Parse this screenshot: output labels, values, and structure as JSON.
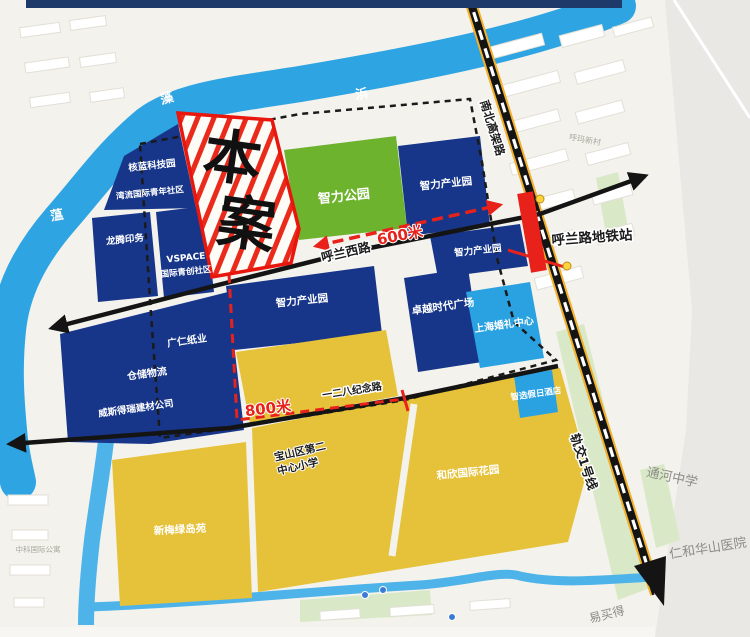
{
  "colors": {
    "block_navy": "#17368a",
    "park_green": "#6db32e",
    "block_yellow": "#e6c23a",
    "block_cyan": "#2aa2e2",
    "river_blue": "#2ea4e2",
    "canal_blue": "#4db3e9",
    "annotation_red": "#e8211a",
    "road_black": "#141414",
    "rail_yellow": "#f2b02c",
    "map_bg": "#f3f2ec",
    "canvas_gray": "#e9e8e4",
    "header_navy": "#1d3a6b",
    "strip_green": "#d9e9c8",
    "site_fill": "#fdfcf7"
  },
  "site": {
    "name": "本案",
    "char_top": "本",
    "char_bottom": "案"
  },
  "river": {
    "name": "蕰藻浜",
    "char_1": "蕰",
    "char_2": "藻",
    "char_3": "浜"
  },
  "roads": {
    "hulan_west": "呼兰西路",
    "north_south_elevated": "南北高架路",
    "memorial_128": "一二八纪念路",
    "metro_line_1": "轨交1号线"
  },
  "transit": {
    "station": "呼兰路地铁站"
  },
  "distances": {
    "to_station": "600米",
    "to_south_road": "800米"
  },
  "blocks": {
    "tech_park": "核蓝科技园",
    "youth_community": "湾流国际青年社区",
    "printing": "龙腾印务",
    "vspace_line1": "VSPACE",
    "vspace_line2": "国际青创社区",
    "zhili_park": "智力公园",
    "zhili_industry": "智力产业园",
    "paper_co": "广仁纸业",
    "warehouse": "仓储物流",
    "building_materials": "威斯得瑞建材公司",
    "zhuoyue_plaza": "卓越时代广场",
    "wedding_center": "上海婚礼中心",
    "holiday_inn": "智选假日酒店",
    "school_line1": "宝山区第二",
    "school_line2": "中心小学",
    "hexin_garden": "和欣国际花园",
    "xinmei_estate": "新梅绿岛苑"
  },
  "landmarks": {
    "tonghe_school": "通河中学",
    "huashan_hospital": "仁和华山医院",
    "emart": "易买得",
    "huma_village": "呼玛新村",
    "zhongke_apartment": "中科国际公寓"
  }
}
